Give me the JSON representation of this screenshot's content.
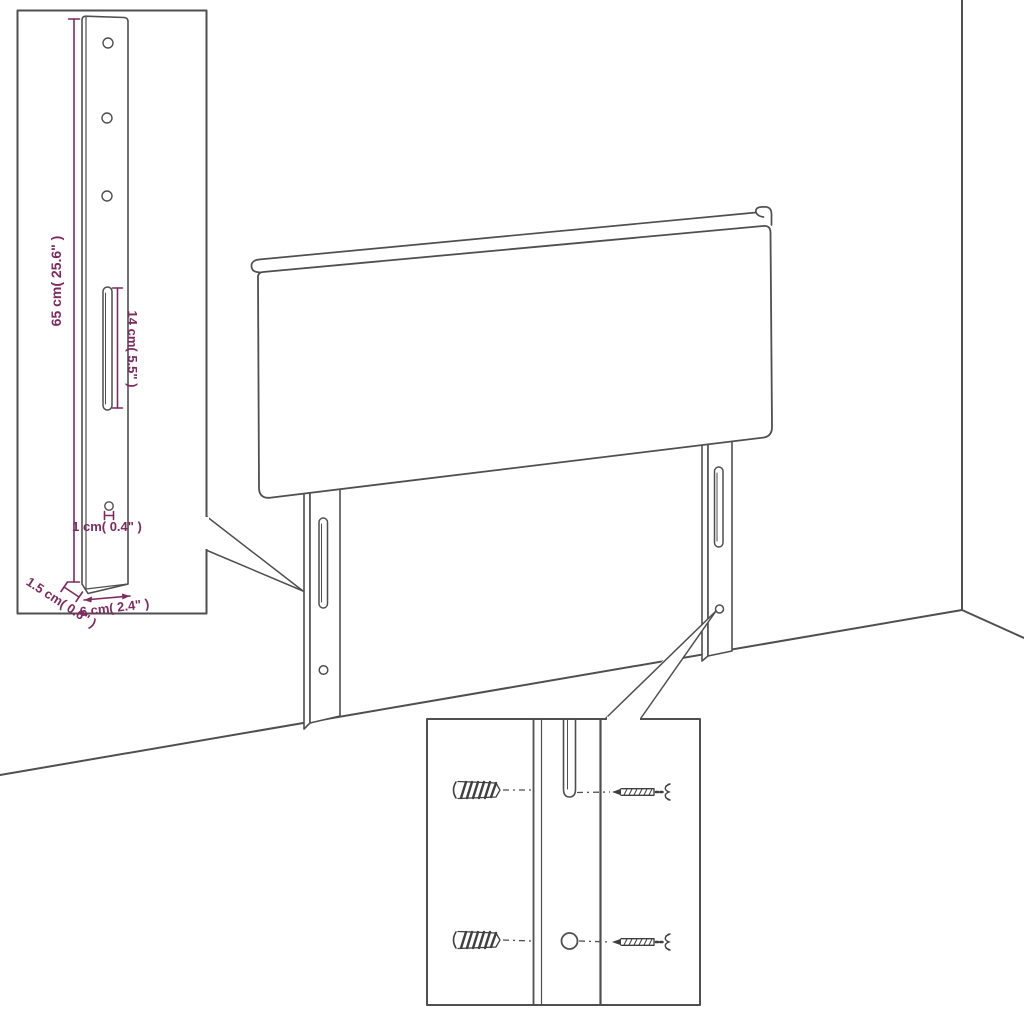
{
  "labels": {
    "leg_height": "65 cm( 25.6\" )",
    "slot_length": "14 cm( 5.5\" )",
    "hole_diameter": "1 cm( 0.4\" )",
    "leg_thickness": "1.5 cm( 0.6\" )",
    "leg_width": "6 cm( 2.4\" )"
  },
  "colors": {
    "dimension": "#7e2a5f",
    "outline": "#4f4f4f",
    "background": "#ffffff"
  }
}
